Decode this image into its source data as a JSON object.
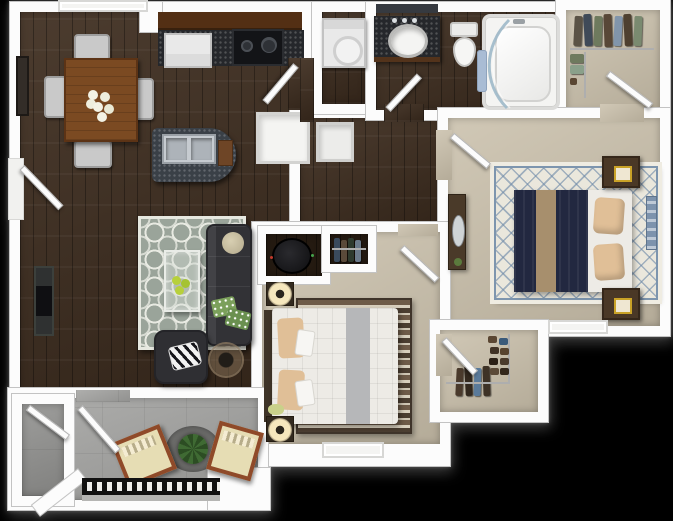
{
  "meta": {
    "label": "3D top-down floor plan render of a two-bedroom, one-bath apartment with balcony",
    "background": "#000000",
    "bedrooms_visible": 2,
    "bathrooms_visible": 1
  },
  "palette": {
    "wall": "#fcfcfc",
    "wallShade": "#c3c3c3",
    "wood": "#3e2d1f",
    "woodDark": "#241a11",
    "carpet": "#c9bfaa",
    "concrete": "#a5a5a3",
    "concreteDark": "#929290",
    "granite": "#25272b",
    "island": "#3a4047",
    "cabinet": "#532f14",
    "fridge": "#e9e9e9",
    "stove": "#131417",
    "sofa": "#323236",
    "rugBase": "#9aa49a",
    "rugPattern": "#eceee6",
    "rugMasterBase": "#eae7dc",
    "rugMasterLine": "#6d89a8",
    "duvet": "#222840",
    "runner": "#a78f6d",
    "pillowTan": "#e0bf97",
    "bedWhite": "#edebe6",
    "nightstand": "#4a3826",
    "woodTable": "#7b4a22",
    "chairGray": "#c9c9c9",
    "chairFrame": "#8f4a29",
    "cushion": "#e6ddb4",
    "plant": "#3f6a33",
    "railingDark": "#111111",
    "lampGlow": "#f6e7bd",
    "towel": "#a9bcd4",
    "glass": "#9fb9c9",
    "runnerGray": "#b6b7b9",
    "artBlue": "#7d93ad",
    "gold": "#c9a227",
    "greenPillow": "#7ba05b",
    "heater": "#17171a",
    "board": "#6e4526"
  },
  "rooms": [
    {
      "id": "dining-area",
      "label": "Dining area",
      "floor": "hardwood",
      "furniture": [
        "dining-table",
        "dining-chair x4",
        "floral-centerpiece",
        "framed-wall-art"
      ]
    },
    {
      "id": "kitchen",
      "label": "Kitchen",
      "floor": "hardwood",
      "furniture": [
        "upper-cabinets",
        "refrigerator",
        "range-stove",
        "granite-counter",
        "island-with-double-sink",
        "cutting-board"
      ]
    },
    {
      "id": "living-room",
      "label": "Living room",
      "floor": "hardwood",
      "furniture": [
        "wall-mounted-tv",
        "quatrefoil-area-rug",
        "sectional-sofa",
        "green-accent-pillows",
        "glass-coffee-table",
        "armchair",
        "zebra-print-pillow",
        "round-side-table"
      ]
    },
    {
      "id": "hallway",
      "label": "Hallway",
      "floor": "hardwood",
      "furniture": [
        "pantry-closet",
        "linen-closet"
      ]
    },
    {
      "id": "laundry-closet",
      "label": "Laundry closet",
      "floor": "hardwood",
      "furniture": [
        "washer-dryer"
      ]
    },
    {
      "id": "bathroom",
      "label": "Bathroom",
      "floor": "hardwood",
      "furniture": [
        "granite-vanity-with-oval-sink",
        "toilet",
        "bathtub",
        "curved-glass-shower-door",
        "towel"
      ]
    },
    {
      "id": "master-walk-in-closet",
      "label": "Master walk-in closet",
      "floor": "carpet",
      "furniture": [
        "hanging-clothes",
        "shoe-shelves"
      ]
    },
    {
      "id": "master-bedroom",
      "label": "Master bedroom",
      "floor": "carpet",
      "furniture": [
        "bed-navy-bedding",
        "nightstand x2",
        "gold-picture-frame x2",
        "dresser-with-mirror",
        "lattice-area-rug",
        "wall-art",
        "window"
      ]
    },
    {
      "id": "bedroom-2",
      "label": "Second bedroom",
      "floor": "carpet",
      "furniture": [
        "bed-white-bedding",
        "nightstand-with-lamp x2",
        "striped-area-rug",
        "small-plant",
        "window"
      ]
    },
    {
      "id": "utility-closet",
      "label": "Water-heater closet",
      "floor": "hardwood",
      "furniture": [
        "water-heater"
      ]
    },
    {
      "id": "reach-in-closet",
      "label": "Reach-in closet",
      "floor": "hardwood",
      "furniture": [
        "hanging-clothes"
      ]
    },
    {
      "id": "walk-in-closet-2",
      "label": "Second walk-in closet",
      "floor": "carpet",
      "furniture": [
        "hanging-clothes",
        "shoe-rack"
      ]
    },
    {
      "id": "balcony",
      "label": "Balcony / patio",
      "floor": "concrete",
      "furniture": [
        "patio-chair x2",
        "round-outdoor-rug",
        "potted-plant",
        "railing"
      ]
    },
    {
      "id": "balcony-storage",
      "label": "Balcony storage closet",
      "floor": "concrete",
      "furniture": []
    }
  ],
  "items": {
    "dining_table": "Dining table",
    "dining_chair": "Dining chair",
    "centerpiece": "Floral centerpiece",
    "wall_art": "Framed wall art",
    "upper_cabinets": "Upper cabinets",
    "refrigerator": "Refrigerator",
    "stove": "Range stove",
    "counter": "Granite counter",
    "island": "Kitchen island",
    "double_sink": "Double-basin sink",
    "cutting_board": "Cutting board",
    "tv": "Wall-mounted TV",
    "living_rug": "Quatrefoil area rug",
    "sofa": "Sectional sofa",
    "round_pillow": "Round pillow",
    "green_pillows": "Green accent pillows",
    "coffee_table": "Glass coffee table",
    "decor_bowl": "Green decor bowl",
    "armchair": "Armchair",
    "zebra_pillow": "Zebra-print pillow",
    "side_table": "Round side table",
    "pantry": "Pantry closet",
    "linen": "Linen closet",
    "washer": "Washer / dryer",
    "vanity": "Granite vanity",
    "sink": "Oval sink",
    "mirror_strip": "Vanity mirror",
    "toilet": "Toilet",
    "tub": "Bathtub",
    "shower_glass": "Curved glass shower door",
    "towel": "Towel",
    "clothes": "Hanging clothes",
    "shoes": "Shoes",
    "master_rug": "Lattice area rug",
    "master_bed": "Bed with navy bedding",
    "pillow": "Pillow",
    "nightstand": "Nightstand",
    "frame_gold": "Gold picture frame",
    "dresser": "Dresser with mirror",
    "bedroom_art": "Wall art",
    "window": "Window",
    "door": "Door",
    "bed2": "Bed with white bedding",
    "lamp": "Table lamp",
    "bed2_rug": "Striped area rug",
    "plant_small": "Small plant",
    "water_heater": "Water heater",
    "railing": "Balcony railing",
    "patio_chair": "Patio chair",
    "patio_rug": "Round outdoor rug",
    "patio_plant": "Potted plant"
  }
}
